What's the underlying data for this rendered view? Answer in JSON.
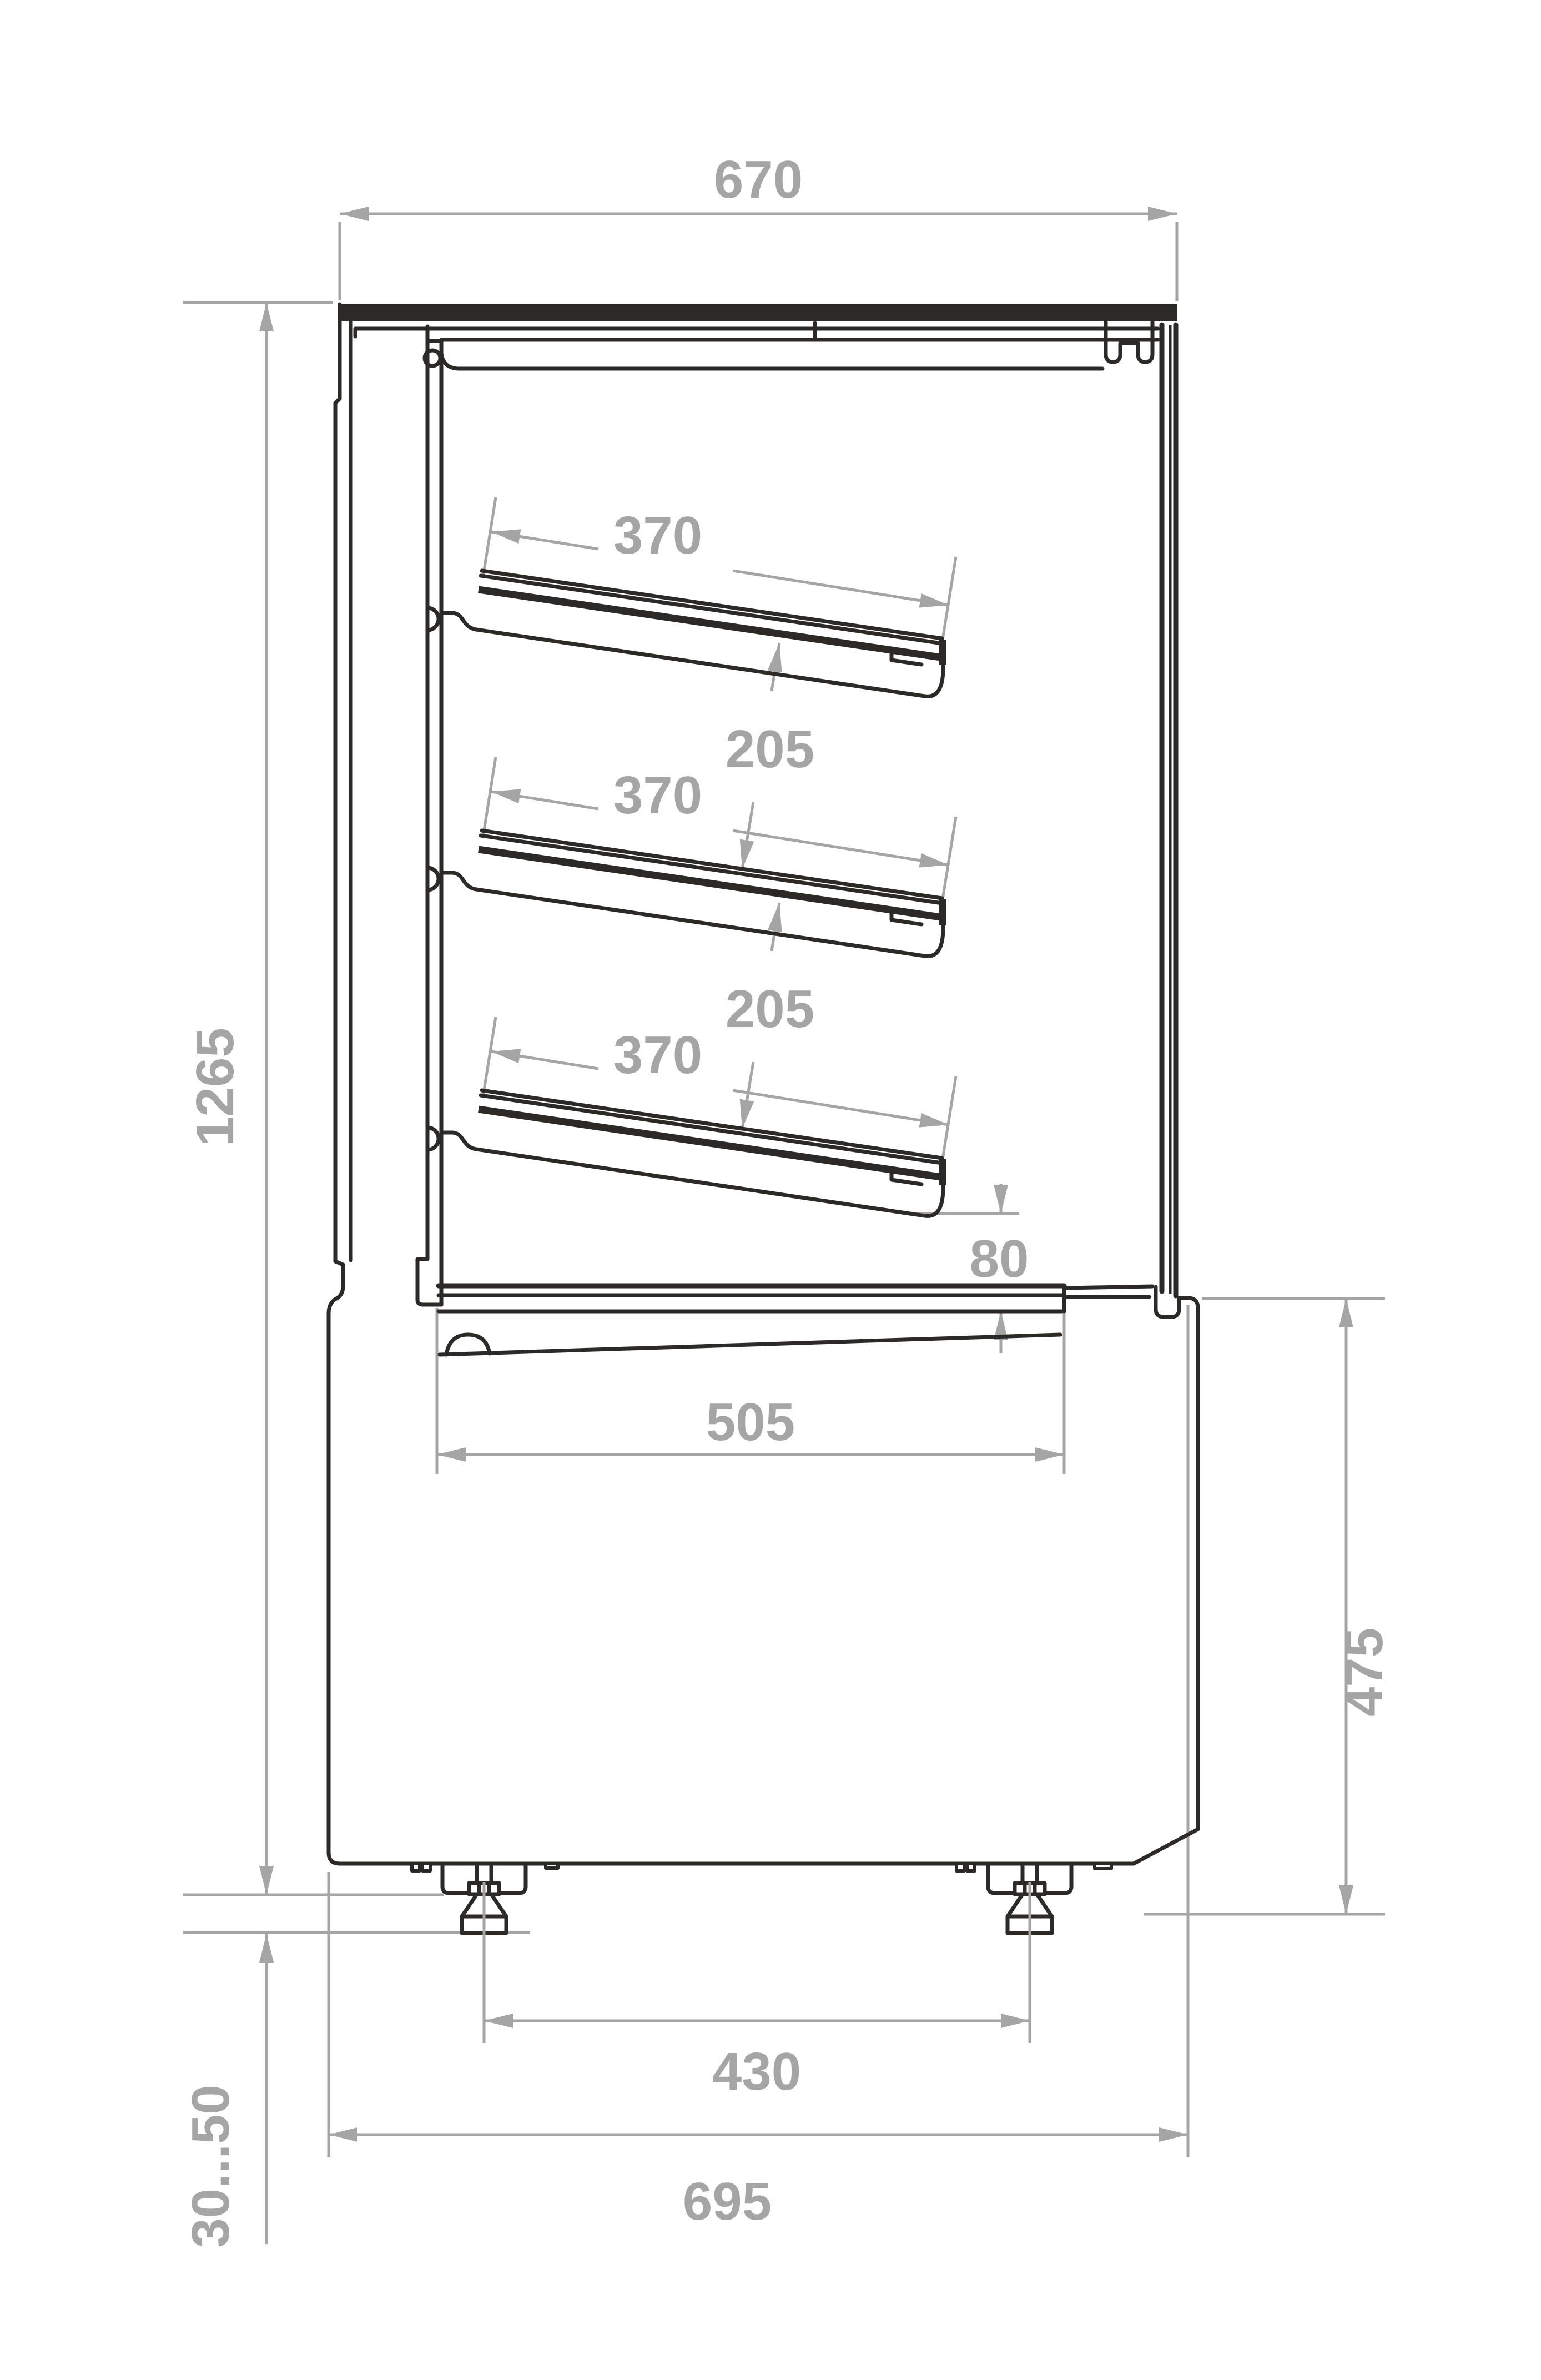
{
  "colors": {
    "background": "#ffffff",
    "outline": "#2b2a29",
    "dimension": "#a6a5a5"
  },
  "dimensions": {
    "top_width": "670",
    "shelf_depth": "370",
    "shelf_spacing": "205",
    "shelf_to_deck_gap": "80",
    "well_depth": "505",
    "overall_height": "1265",
    "base_height": "475",
    "feet_spacing": "430",
    "base_depth": "695",
    "feet_height_range": "30...50"
  }
}
